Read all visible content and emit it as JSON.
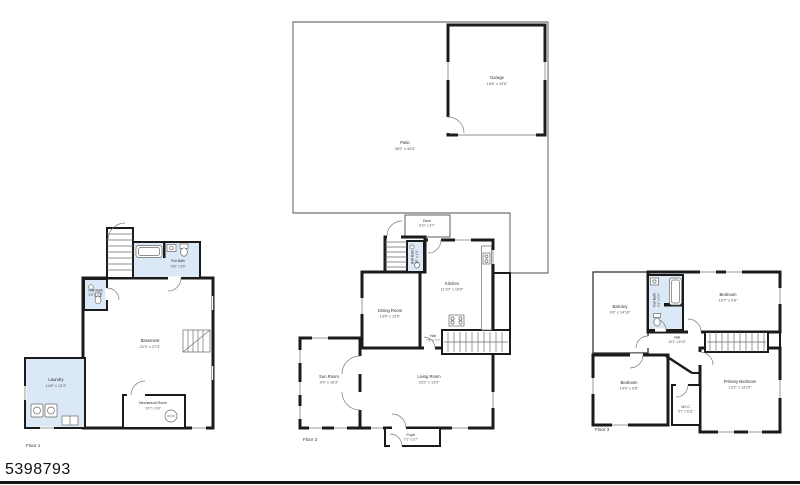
{
  "page": {
    "mls_number": "5398793"
  },
  "colors": {
    "wall": "#1b1b1b",
    "wet_room_fill": "#dbe8f5",
    "outline": "#4d4d4d"
  },
  "floors": {
    "floor1": {
      "label": "Floor 1",
      "rooms": {
        "full_bath": {
          "name": "Full Bath",
          "dims": "10'9\" x 5'6\""
        },
        "half_bath": {
          "name": "Half Bath",
          "dims": "3'6\" x 4'2\""
        },
        "basement": {
          "name": "Basement",
          "dims": "22'3\" x 27'3\""
        },
        "laundry": {
          "name": "Laundry",
          "dims": "14'8\" x 13'3\""
        },
        "mechanical": {
          "name": "Mechanical Room",
          "dims": "10'7\" x 9'9\""
        }
      }
    },
    "floor2": {
      "label": "Floor 2",
      "rooms": {
        "patio": {
          "name": "Patio",
          "dims": "48'2\" x 44'5\""
        },
        "garage": {
          "name": "Garage",
          "dims": "16'8\" x 19'6\""
        },
        "deck": {
          "name": "Deck",
          "dims": "8'11\" x 3'7\""
        },
        "half_bath": {
          "name": "Half Bath",
          "dims": "3'0\" x 4'6\""
        },
        "kitchen": {
          "name": "Kitchen",
          "dims": "11'10\" x 15'9\""
        },
        "dining": {
          "name": "Dining Room",
          "dims": "13'9\" x 13'5\""
        },
        "hall": {
          "name": "Hall",
          "dims": "7'9\" x 7'1\""
        },
        "sun_room": {
          "name": "Sun Room",
          "dims": "9'9\" x 19'3\""
        },
        "living": {
          "name": "Living Room",
          "dims": "23'2\" x 13'9\""
        },
        "foyer": {
          "name": "Foyer",
          "dims": "7'1\" x 3'7\""
        }
      }
    },
    "floor3": {
      "label": "Floor 3",
      "rooms": {
        "balcony": {
          "name": "Balcony",
          "dims": "9'9\" x 14'10\""
        },
        "full_bath": {
          "name": "Full Bath",
          "dims": "5'3\" x 9'9\""
        },
        "bedroom_top": {
          "name": "Bedroom",
          "dims": "16'7\" x 9'8\""
        },
        "hall": {
          "name": "Hall",
          "dims": "10'1\" x 5'10\""
        },
        "bedroom_left": {
          "name": "Bedroom",
          "dims": "14'4\" x 9'8\""
        },
        "primary": {
          "name": "Primary Bedroom",
          "dims": "13'2\" x 13'10\""
        },
        "wic": {
          "name": "W.I.C.",
          "dims": "5'1\" x 6'11\""
        }
      }
    }
  }
}
